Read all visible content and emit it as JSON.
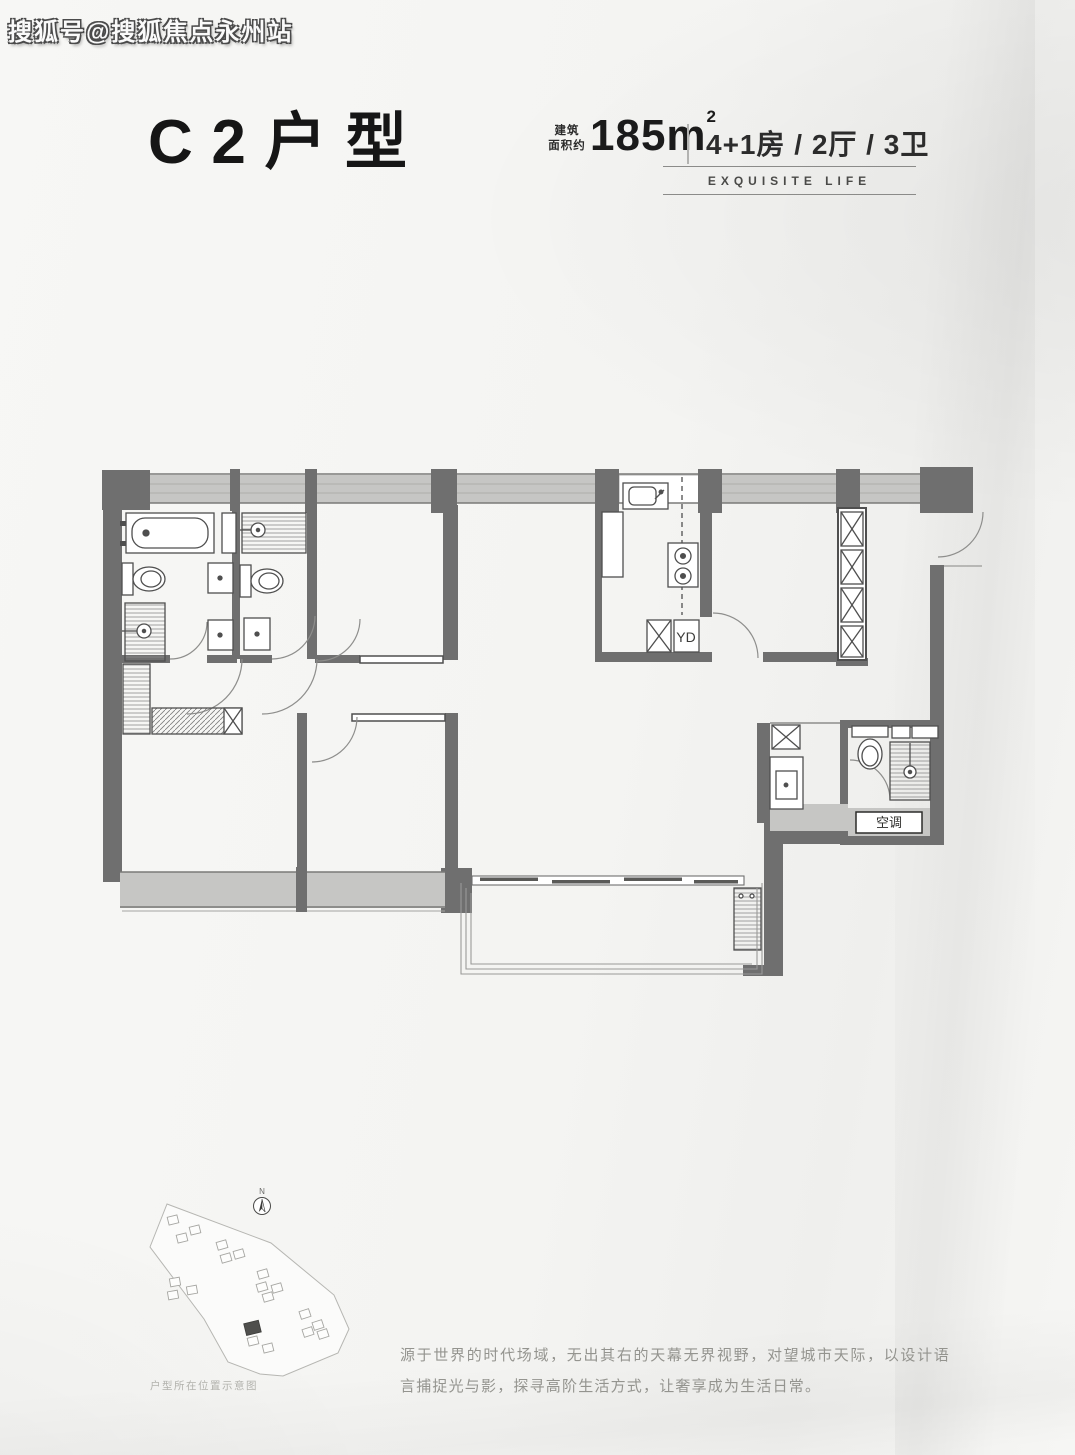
{
  "watermark": {
    "text": "搜狐号@搜狐焦点永州站"
  },
  "header": {
    "title": "C2户型",
    "area_prefix_line1": "建筑",
    "area_prefix_line2": "面积约",
    "area_value": "185m",
    "area_sup": "2",
    "layout_spec": "4+1房 / 2厅 / 3卫",
    "tagline": "EXQUISITE LIFE"
  },
  "floorplan": {
    "labels": {
      "laundry": "YD",
      "ac": "空调"
    }
  },
  "sitemap": {
    "north_label": "N",
    "caption": "户型所在位置示意图"
  },
  "description": {
    "text": "源于世界的时代场域，无出其右的天幕无界视野，对望城市天际，以设计语言捕捉光与影，探寻高阶生活方式，让奢享成为生活日常。"
  },
  "colors": {
    "wall": "#6f6f6f",
    "band": "#c6c6c4",
    "edge": "#7a7a78",
    "fix": "#4f4f4f",
    "arc": "#8e8e8c",
    "bg": "#f6f6f4",
    "ink": "#161616",
    "gray": "#94948f"
  }
}
